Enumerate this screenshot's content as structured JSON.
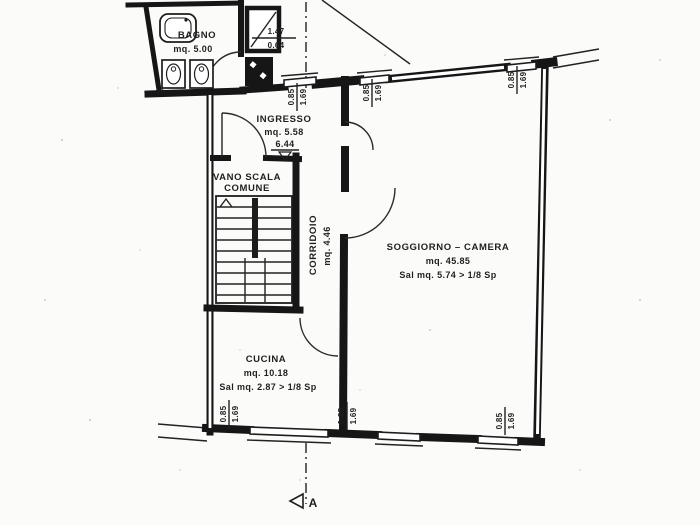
{
  "drawing": {
    "type": "floor-plan-scan",
    "section_letter": "A"
  },
  "rooms": {
    "bagno": {
      "name": "BAGNO",
      "area": "mq. 5.00"
    },
    "ingresso": {
      "name": "INGRESSO",
      "area": "mq. 5.58",
      "elevation": "6.44"
    },
    "vano_scala": {
      "line1": "VANO SCALA",
      "line2": "COMUNE"
    },
    "corridoio": {
      "name": "CORRIDOIO",
      "area": "mq. 4.46"
    },
    "soggiorno": {
      "name": "SOGGIORNO – CAMERA",
      "area": "mq. 45.85",
      "note": "Sal mq. 5.74 > 1/8 Sp"
    },
    "cucina": {
      "name": "CUCINA",
      "area": "mq. 10.18",
      "note": "Sal mq. 2.87 > 1/8 Sp"
    }
  },
  "dimensions": {
    "window": {
      "num": "0.85",
      "den": "1.69"
    },
    "bagno_window": {
      "num": "1.47",
      "den": "0.64"
    },
    "threshold_mark": "53"
  },
  "colors": {
    "ink": "#161616",
    "paper": "#fbfbf9"
  }
}
